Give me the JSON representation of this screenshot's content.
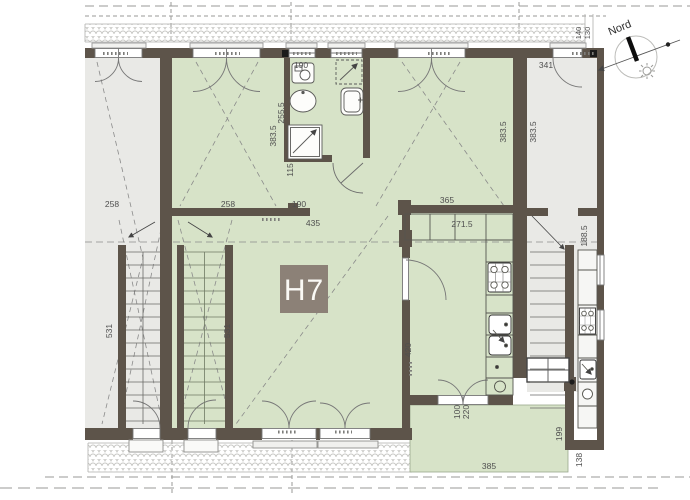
{
  "unit": {
    "label": "H7"
  },
  "compass": {
    "label": "Nord"
  },
  "colors": {
    "unit_fill": "#d7e3c8",
    "neighbor_fill": "#e9e9e6",
    "wall": "#5d544a",
    "badge": "#8c8177",
    "porch_fill": "#dce6cd"
  },
  "dims": {
    "roof_edge_a": "140",
    "roof_edge_b": "130",
    "neighbor_room_width": "341",
    "neighbor_room_depth": "383.5",
    "bath_width": "190",
    "bath_side_a": "255.5",
    "bath_side_b": "383.5",
    "bath_bottom": "115",
    "bed_right_depth": "383.5",
    "neighbor_left_hall": "258",
    "hall_top": "258",
    "hall_pier": "190",
    "hall_width": "435",
    "kitchen_wall": "365",
    "kitchen_counter": "271.5",
    "stair_left": "531",
    "stair_right": "531",
    "neighbor_stair": "188.5",
    "living_depth": "420",
    "door_width": "100",
    "door_height": "220",
    "terrace_width": "385",
    "terrace_depth": "199",
    "neighbor_terrace": "138"
  }
}
